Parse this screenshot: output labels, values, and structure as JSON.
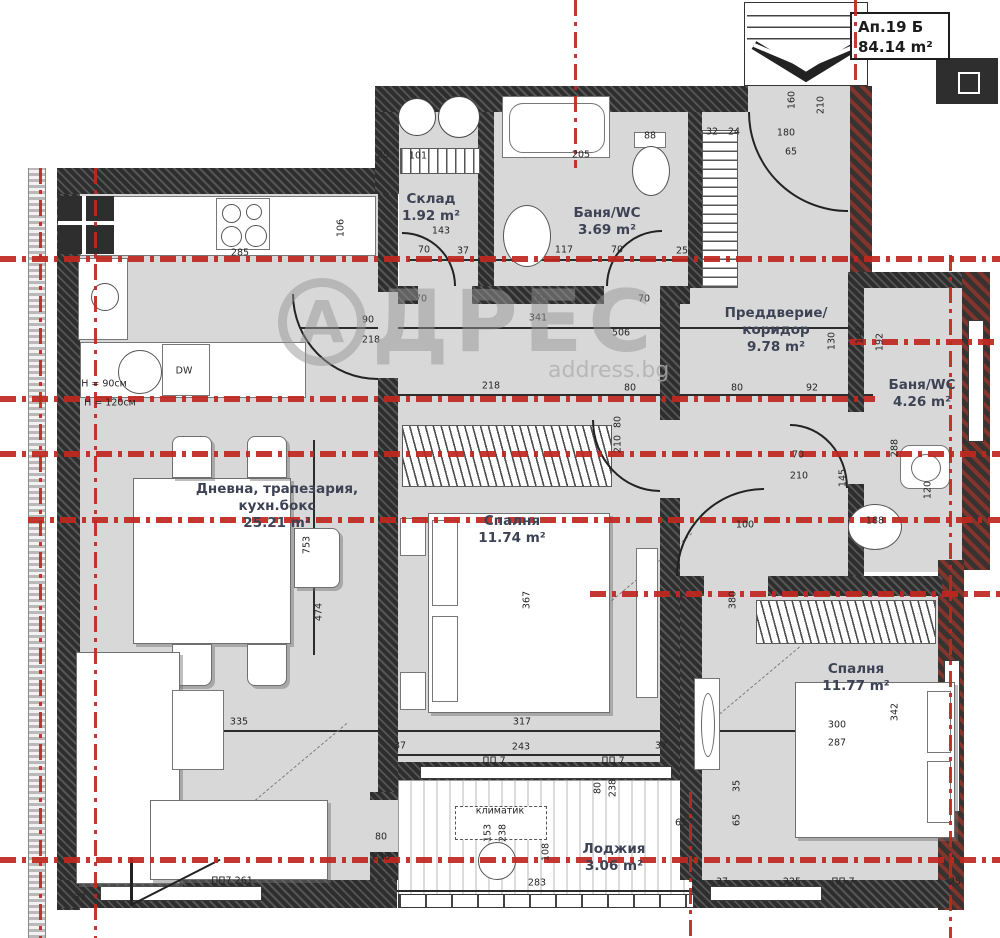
{
  "unit": {
    "name": "Ап.19 Б",
    "area": "84.14 m²"
  },
  "watermark": {
    "initial": "А",
    "rest": "ДРЕС",
    "site": "address.bg"
  },
  "colors": {
    "axis_red": "#c0271f",
    "wall_dark": "#474747",
    "wall_brick": "#81352c",
    "room_fill": "#d8d8d8",
    "label": "#3d4254",
    "watermark": "#a8a8a8"
  },
  "rooms": [
    {
      "name": "Склад",
      "area": "1.92 m²"
    },
    {
      "name": "Баня/WC",
      "area": "3.69 m²"
    },
    {
      "name": "Преддверие/\nкоридор",
      "area": "9.78 m²"
    },
    {
      "name": "Баня/WC",
      "area": "4.26 m²"
    },
    {
      "name": "Дневна, трапезария,\nкухн.бокс",
      "area": "25.21 m²"
    },
    {
      "name": "Спалня",
      "area": "11.74 m²"
    },
    {
      "name": "Спалня",
      "area": "11.77 m²"
    },
    {
      "name": "Лоджия",
      "area": "3.06 m²"
    }
  ],
  "dimensions": [
    {
      "t": "25",
      "x": 383,
      "y": 155
    },
    {
      "t": "101",
      "x": 418,
      "y": 156
    },
    {
      "t": "205",
      "x": 581,
      "y": 155
    },
    {
      "t": "88",
      "x": 650,
      "y": 136
    },
    {
      "t": "32",
      "x": 712,
      "y": 132
    },
    {
      "t": "24",
      "x": 734,
      "y": 132
    },
    {
      "t": "180",
      "x": 786,
      "y": 133
    },
    {
      "t": "65",
      "x": 791,
      "y": 152
    },
    {
      "t": "160",
      "x": 792,
      "y": 100,
      "r": 1
    },
    {
      "t": "210",
      "x": 821,
      "y": 105,
      "r": 1
    },
    {
      "t": "106",
      "x": 341,
      "y": 228,
      "r": 1
    },
    {
      "t": "143",
      "x": 441,
      "y": 231
    },
    {
      "t": "70",
      "x": 424,
      "y": 250
    },
    {
      "t": "37",
      "x": 463,
      "y": 251
    },
    {
      "t": "117",
      "x": 564,
      "y": 250
    },
    {
      "t": "70",
      "x": 617,
      "y": 250
    },
    {
      "t": "25",
      "x": 682,
      "y": 251
    },
    {
      "t": "285",
      "x": 240,
      "y": 253
    },
    {
      "t": "70",
      "x": 421,
      "y": 299
    },
    {
      "t": "165",
      "x": 539,
      "y": 299
    },
    {
      "t": "341",
      "x": 538,
      "y": 318
    },
    {
      "t": "506",
      "x": 621,
      "y": 333
    },
    {
      "t": "70",
      "x": 644,
      "y": 299
    },
    {
      "t": "90",
      "x": 368,
      "y": 320
    },
    {
      "t": "218",
      "x": 371,
      "y": 340
    },
    {
      "t": "192",
      "x": 880,
      "y": 342,
      "r": 1
    },
    {
      "t": "130",
      "x": 832,
      "y": 341,
      "r": 1
    },
    {
      "t": "142",
      "x": 860,
      "y": 335,
      "r": 1
    },
    {
      "t": "218",
      "x": 491,
      "y": 386
    },
    {
      "t": "80",
      "x": 630,
      "y": 388
    },
    {
      "t": "80",
      "x": 737,
      "y": 388
    },
    {
      "t": "92",
      "x": 812,
      "y": 388
    },
    {
      "t": "80",
      "x": 618,
      "y": 422,
      "r": 1
    },
    {
      "t": "210",
      "x": 618,
      "y": 444,
      "r": 1
    },
    {
      "t": "70",
      "x": 798,
      "y": 455
    },
    {
      "t": "210",
      "x": 799,
      "y": 476
    },
    {
      "t": "145",
      "x": 843,
      "y": 478,
      "r": 1
    },
    {
      "t": "288",
      "x": 895,
      "y": 448,
      "r": 1
    },
    {
      "t": "120",
      "x": 928,
      "y": 490,
      "r": 1
    },
    {
      "t": "188",
      "x": 875,
      "y": 521
    },
    {
      "t": "100",
      "x": 745,
      "y": 525
    },
    {
      "t": "380",
      "x": 733,
      "y": 600,
      "r": 1
    },
    {
      "t": "753",
      "x": 307,
      "y": 545,
      "r": 1
    },
    {
      "t": "474",
      "x": 319,
      "y": 612,
      "r": 1
    },
    {
      "t": "367",
      "x": 527,
      "y": 600,
      "r": 1
    },
    {
      "t": "335",
      "x": 239,
      "y": 722
    },
    {
      "t": "317",
      "x": 522,
      "y": 722
    },
    {
      "t": "243",
      "x": 521,
      "y": 747
    },
    {
      "t": "37",
      "x": 400,
      "y": 746
    },
    {
      "t": "37",
      "x": 661,
      "y": 746
    },
    {
      "t": "ПП 7",
      "x": 494,
      "y": 761
    },
    {
      "t": "ПП 7",
      "x": 613,
      "y": 761
    },
    {
      "t": "80",
      "x": 598,
      "y": 788,
      "r": 1
    },
    {
      "t": "238",
      "x": 613,
      "y": 788,
      "r": 1
    },
    {
      "t": "80",
      "x": 381,
      "y": 837
    },
    {
      "t": "238",
      "x": 381,
      "y": 857
    },
    {
      "t": "климатик",
      "x": 500,
      "y": 811
    },
    {
      "t": "153",
      "x": 488,
      "y": 833,
      "r": 1
    },
    {
      "t": "238",
      "x": 503,
      "y": 833,
      "r": 1
    },
    {
      "t": "108",
      "x": 546,
      "y": 852,
      "r": 1
    },
    {
      "t": "283",
      "x": 537,
      "y": 883
    },
    {
      "t": "65",
      "x": 681,
      "y": 823
    },
    {
      "t": "35",
      "x": 737,
      "y": 786,
      "r": 1
    },
    {
      "t": "65",
      "x": 737,
      "y": 820,
      "r": 1
    },
    {
      "t": "300",
      "x": 837,
      "y": 725
    },
    {
      "t": "287",
      "x": 837,
      "y": 743
    },
    {
      "t": "342",
      "x": 895,
      "y": 712,
      "r": 1
    },
    {
      "t": "37",
      "x": 722,
      "y": 882
    },
    {
      "t": "225",
      "x": 792,
      "y": 882
    },
    {
      "t": "ПП 7",
      "x": 843,
      "y": 882
    },
    {
      "t": "25",
      "x": 955,
      "y": 882
    },
    {
      "t": "ПП7  261",
      "x": 232,
      "y": 881
    },
    {
      "t": "37",
      "x": 80,
      "y": 898
    },
    {
      "t": "DW",
      "x": 184,
      "y": 371
    },
    {
      "t": "H = 90см",
      "x": 104,
      "y": 384
    },
    {
      "t": "H = 120см",
      "x": 110,
      "y": 403
    }
  ],
  "axes": {
    "h": [
      {
        "y": 257,
        "x1": 0,
        "x2": 1000
      },
      {
        "y": 340,
        "x1": 850,
        "x2": 1000
      },
      {
        "y": 397,
        "x1": 0,
        "x2": 875
      },
      {
        "y": 452,
        "x1": 0,
        "x2": 1000
      },
      {
        "y": 518,
        "x1": 28,
        "x2": 1000
      },
      {
        "y": 592,
        "x1": 590,
        "x2": 1000
      },
      {
        "y": 858,
        "x1": 0,
        "x2": 1000
      }
    ],
    "v": [
      {
        "x": 40,
        "y1": 168,
        "y2": 938
      },
      {
        "x": 95,
        "y1": 168,
        "y2": 938
      },
      {
        "x": 575,
        "y1": 0,
        "y2": 168
      },
      {
        "x": 855,
        "y1": 0,
        "y2": 86
      },
      {
        "x": 950,
        "y1": 255,
        "y2": 938
      },
      {
        "x": 690,
        "y1": 792,
        "y2": 938
      }
    ]
  }
}
